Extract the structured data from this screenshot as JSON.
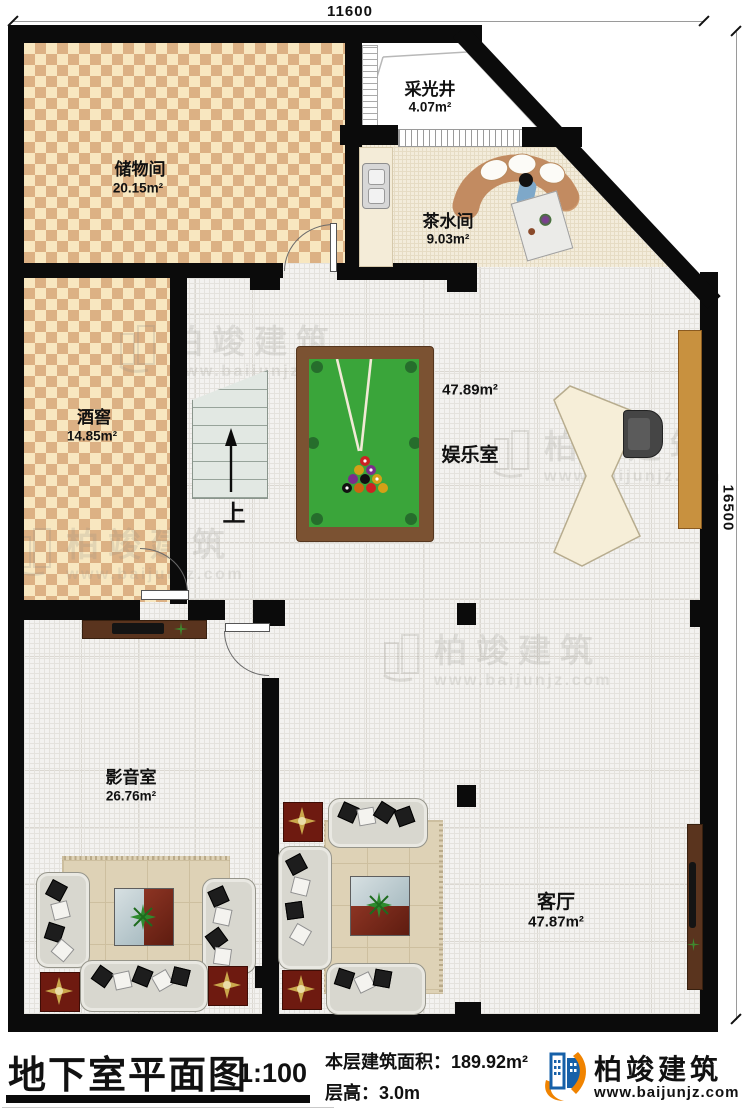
{
  "dimensions": {
    "top": "11600",
    "right": "16500"
  },
  "rooms": {
    "storage": {
      "name": "储物间",
      "area": "20.15m²"
    },
    "lightwell": {
      "name": "采光井",
      "area": "4.07m²"
    },
    "tea": {
      "name": "茶水间",
      "area": "9.03m²"
    },
    "cellar": {
      "name": "酒窖",
      "area": "14.85m²"
    },
    "entertainment": {
      "name": "娱乐室",
      "area": "47.89m²"
    },
    "av": {
      "name": "影音室",
      "area": "26.76m²"
    },
    "living": {
      "name": "客厅",
      "area": "47.87m²"
    }
  },
  "stairs": {
    "up": "上"
  },
  "watermark": {
    "brand": "柏竣建筑",
    "url": "www.baijunjz.com"
  },
  "footer": {
    "title": "地下室平面图",
    "scale": "1:100",
    "area_line": "本层建筑面积：189.92m²",
    "height_line": "层高：3.0m",
    "brand": "柏竣建筑",
    "brand_url": "www.baijunjz.com"
  },
  "colors": {
    "wall": "#0b0b0b",
    "checker_light": "#f8e7c0",
    "checker_dark": "#dcb184",
    "billiard_frame": "#7b5232",
    "billiard_felt": "#3aa53a",
    "logo_blue": "#1660a8",
    "logo_orange": "#f08300",
    "stair_fill": "#e3e9e4",
    "cabinet": "#c8913f",
    "tv_cabinet": "#5a341e",
    "red_table": "#6e1a10"
  }
}
